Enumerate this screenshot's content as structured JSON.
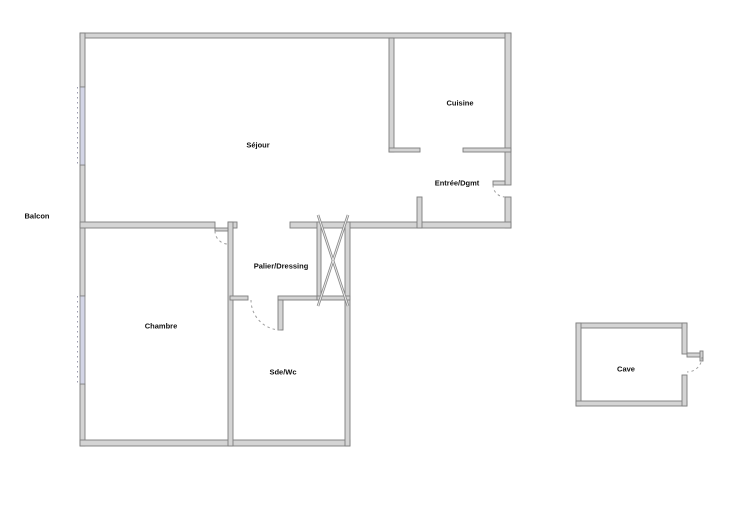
{
  "plan": {
    "rooms": [
      {
        "name": "Balcon"
      },
      {
        "name": "Séjour"
      },
      {
        "name": "Cuisine"
      },
      {
        "name": "Entrée/Dgmt"
      },
      {
        "name": "Palier/Dressing"
      },
      {
        "name": "Chambre"
      },
      {
        "name": "Sde/Wc"
      },
      {
        "name": "Cave"
      }
    ],
    "colors": {
      "wall-fill": "#d4d4d4",
      "wall-stroke": "#7d7d7d",
      "window-fill": "#d3d5e6",
      "arc-color": "#9e9e9e",
      "label-color": "#111111",
      "bg": "#ffffff"
    }
  }
}
